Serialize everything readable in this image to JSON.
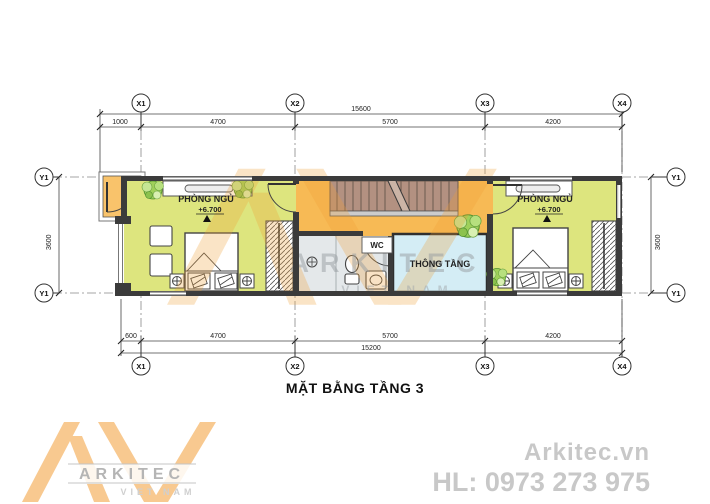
{
  "title": "MẶT BẰNG TẦNG 3",
  "grid": {
    "x_labels": [
      "X1",
      "X2",
      "X3",
      "X4"
    ],
    "y_label": "Y1"
  },
  "dims": {
    "top_total": "15600",
    "top_segments": [
      "1000",
      "4700",
      "5700",
      "4200"
    ],
    "bottom_total": "15200",
    "bottom_segments": [
      "600",
      "4700",
      "5700",
      "4200"
    ],
    "height_left": "3600",
    "height_right": "3600"
  },
  "rooms": {
    "bedroom_left": {
      "name": "PHÒNG NGỦ",
      "level": "+6.700"
    },
    "bedroom_right": {
      "name": "PHÒNG NGỦ",
      "level": "+6.700"
    },
    "wc": {
      "name": "WC"
    },
    "void": {
      "name": "THÔNG TẦNG"
    }
  },
  "watermark": {
    "brand": "ARKITEC",
    "country": "VIET NAM"
  },
  "logo": {
    "brand": "ARKITEC",
    "country": "VIET NAM"
  },
  "contact": {
    "website": "Arkitec.vn",
    "hotline": "HL: 0973 273 975"
  },
  "colors": {
    "bedroom_fill": "#dde57e",
    "hall_fill": "#f7ba55",
    "balcony_fill": "#f9c36b",
    "stair_fill": "#b39181",
    "void_fill": "#d4edf5",
    "wc_fill": "#e4e8ea",
    "wall": "#3b3b3b",
    "logo_orange": "#f8c990",
    "logo_gray": "#b5b5b5",
    "contact_gray": "#c8c8c8"
  }
}
